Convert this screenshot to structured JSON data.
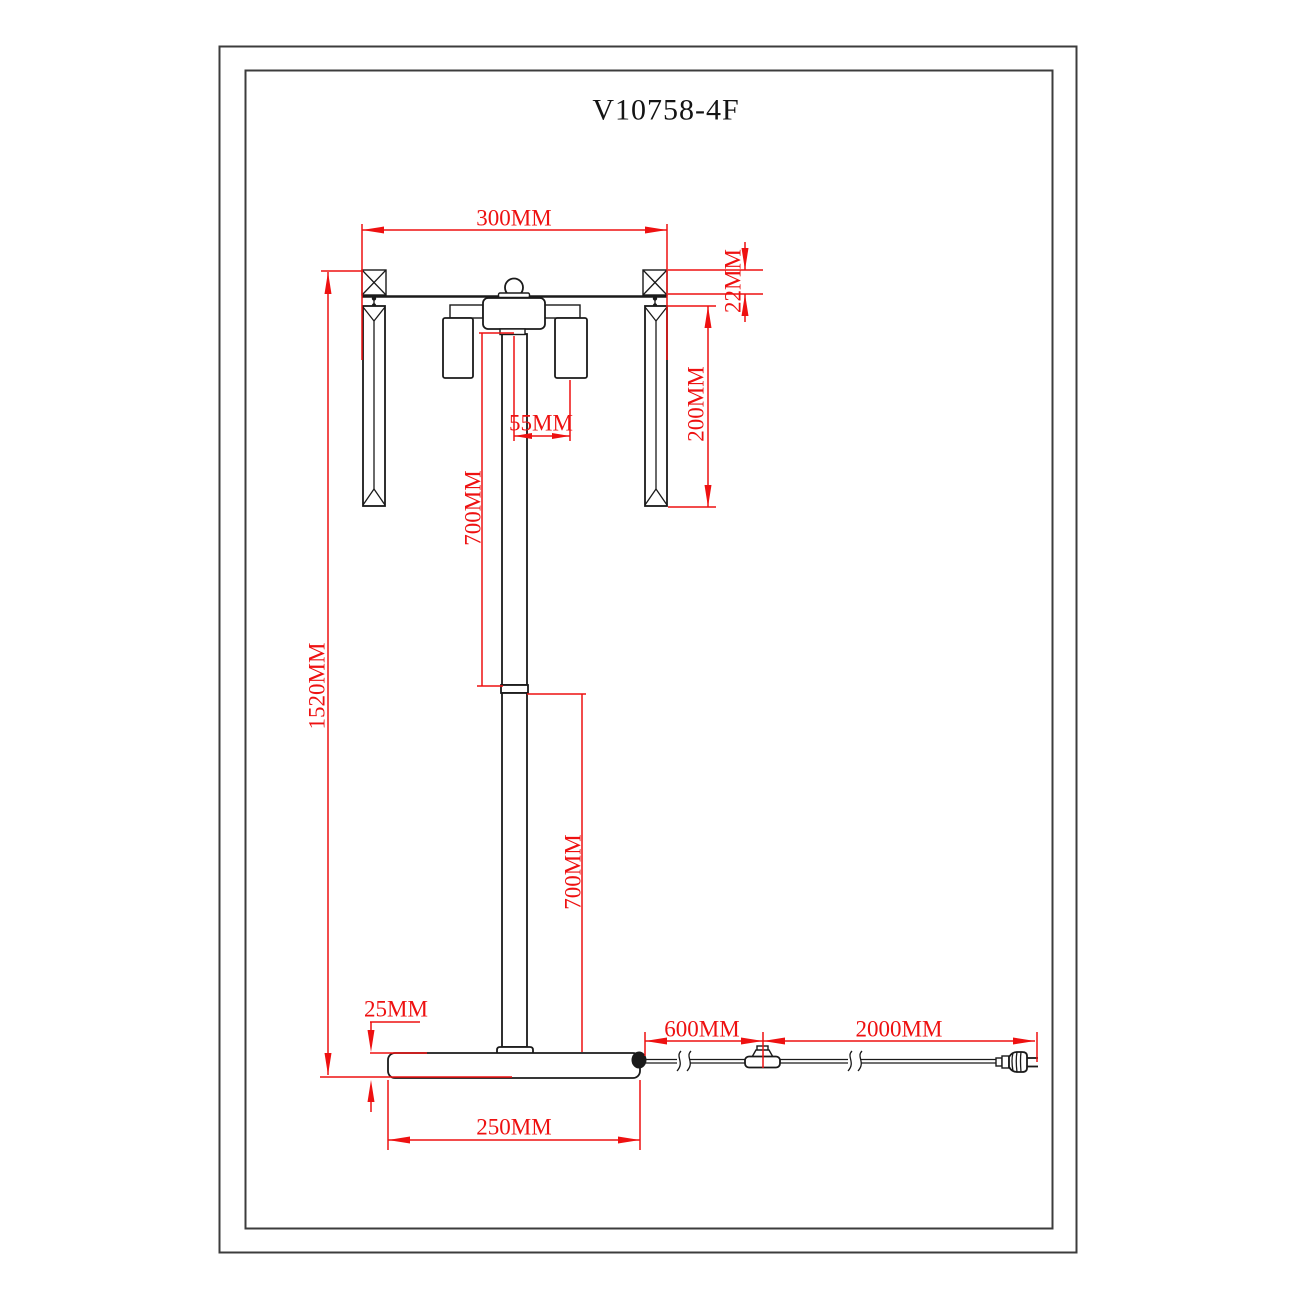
{
  "drawing": {
    "title": "V10758-4F",
    "colors": {
      "line": "#1a1a1a",
      "dimension": "#ee1111",
      "frame": "#3c3c3c",
      "background": "#ffffff"
    },
    "dimensions": {
      "top_width": "300MM",
      "hanger_height": "22MM",
      "crystal_length": "200MM",
      "shade_offset": "55MM",
      "upper_pole": "700MM",
      "total_height": "1520MM",
      "lower_pole": "700MM",
      "base_thickness": "25MM",
      "base_width": "250MM",
      "cord_to_switch": "600MM",
      "switch_to_plug": "2000MM"
    }
  }
}
